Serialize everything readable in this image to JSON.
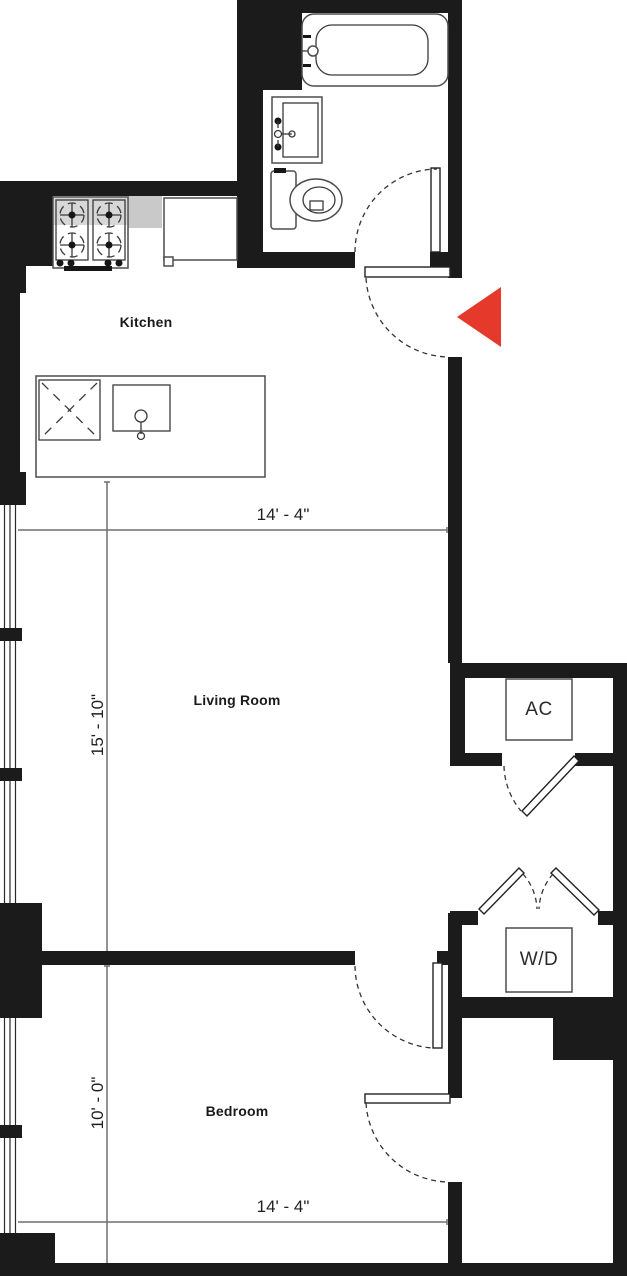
{
  "floor_plan": {
    "rooms": [
      {
        "label": "Kitchen"
      },
      {
        "label": "Living Room"
      },
      {
        "label": "Bedroom"
      }
    ],
    "closets": [
      {
        "label": "AC"
      },
      {
        "label": "W/D"
      }
    ],
    "dimensions": {
      "living_width": "14' - 4\"",
      "living_height": "15' - 10\"",
      "bedroom_height": "10' - 0\"",
      "bedroom_width": "14' - 4\""
    },
    "colors": {
      "wall": "#1b1b1b",
      "entry_arrow_red": "#e5392c",
      "dimension_line": "#6e6e6e",
      "counter_gray": "#c9c9c9"
    },
    "fixtures": [
      "bathtub",
      "bathroom-sink",
      "toilet",
      "stove",
      "kitchen-counter",
      "kitchen-island",
      "island-sink",
      "ac-unit",
      "washer-dryer",
      "entry-arrow"
    ]
  }
}
